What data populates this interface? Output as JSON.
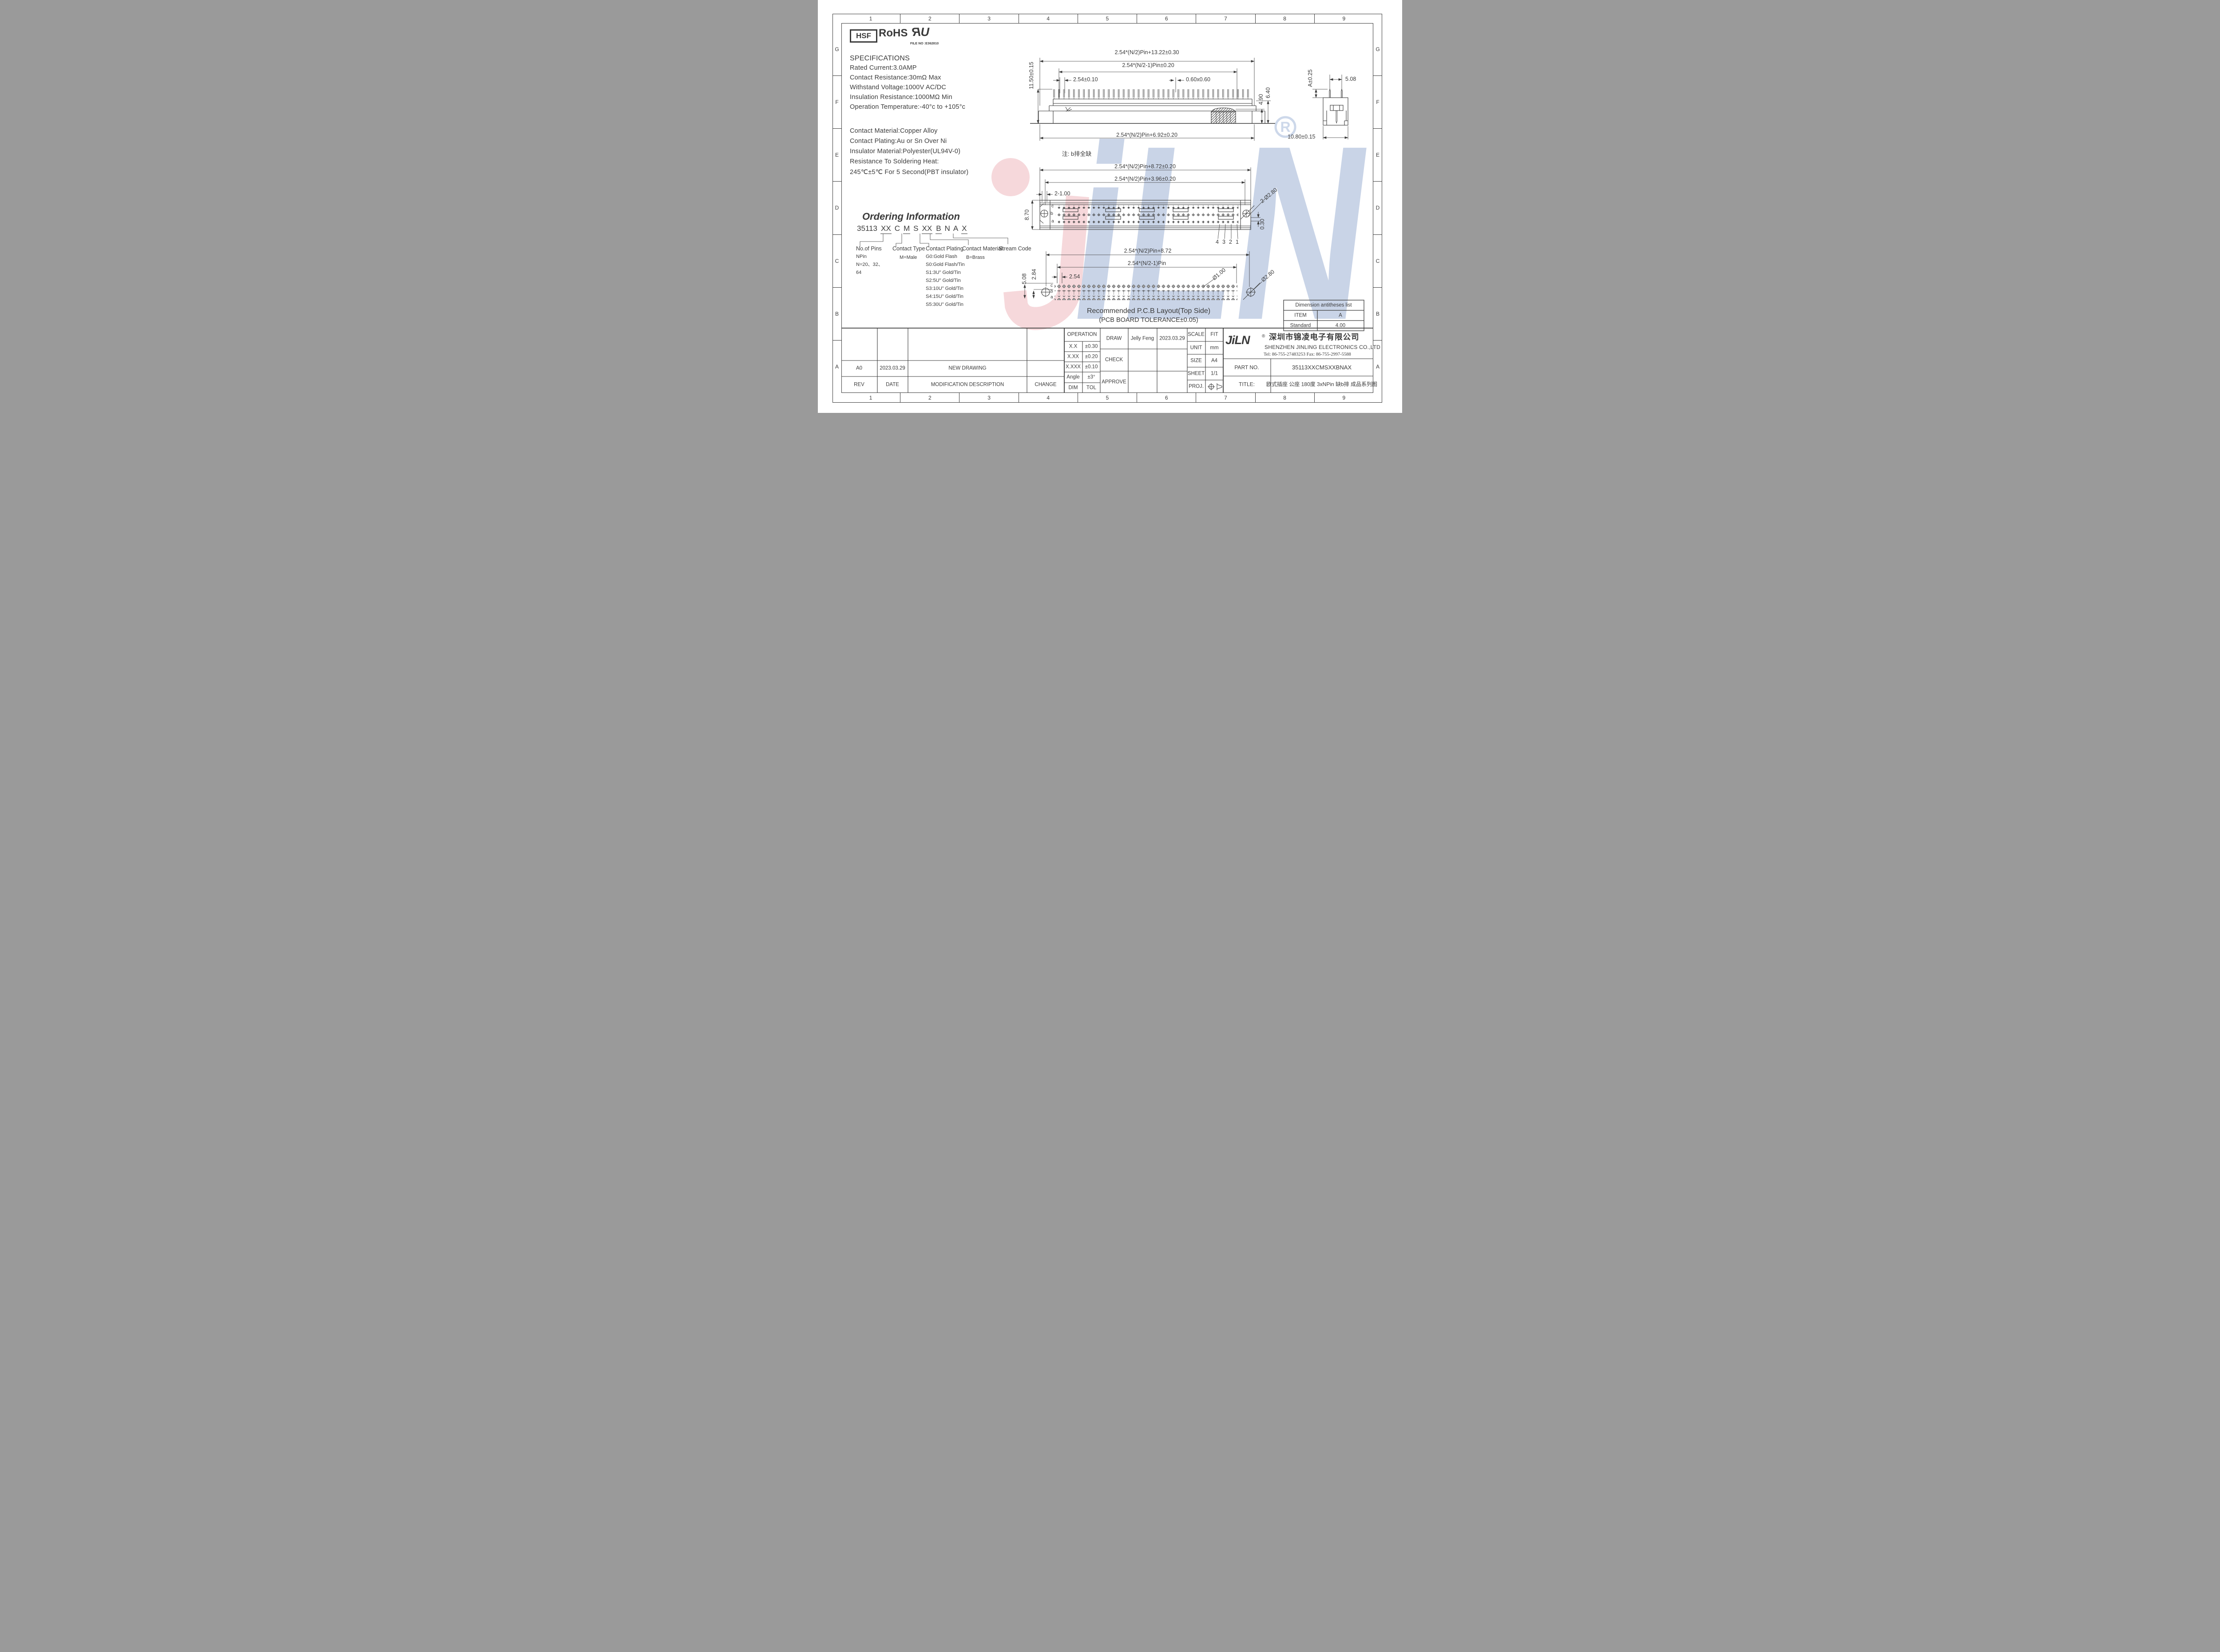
{
  "sheet": {
    "line_color": "#3a3a3a",
    "watermark_blue": "#c9d4e7",
    "watermark_pink": "#f5d6da"
  },
  "border": {
    "columns": [
      "1",
      "2",
      "3",
      "4",
      "5",
      "6",
      "7",
      "8",
      "9"
    ],
    "rows": [
      "G",
      "F",
      "E",
      "D",
      "C",
      "B",
      "A"
    ]
  },
  "certs": {
    "hsf": "HSF",
    "rohs": "RoHS",
    "ul_r": "R",
    "ul_u": "U",
    "ul_file": "FILE NO :E362810"
  },
  "specs": {
    "title": "SPECIFICATIONS",
    "lines": [
      "Rated Current:3.0AMP",
      "Contact Resistance:30mΩ Max",
      "Withstand Voltage:1000V AC/DC",
      "Insulation Resistance:1000MΩ Min",
      "Operation Temperature:-40°c to +105°c"
    ],
    "material_lines": [
      "Contact Material:Copper Alloy",
      "Contact Plating:Au or Sn Over Ni",
      "Insulator Material:Polyester(UL94V-0)",
      "Resistance To Soldering Heat:",
      "245℃±5℃ For 5 Second(PBT insulator)"
    ]
  },
  "ordering": {
    "title": "Ordering Information",
    "code": [
      {
        "t": "35113"
      },
      {
        "t": "XX"
      },
      {
        "t": "C"
      },
      {
        "t": "M"
      },
      {
        "t": "S"
      },
      {
        "t": "XX"
      },
      {
        "t": "B"
      },
      {
        "t": "N"
      },
      {
        "t": "A"
      },
      {
        "t": "X"
      }
    ],
    "no_of_pins": {
      "label": "No.of Pins",
      "l1": "NPin",
      "l2": "N=20、32、",
      "l3": "64"
    },
    "contact_type": {
      "label": "Contact Type",
      "l1": "M=Male"
    },
    "contact_plating": {
      "label": "Contact Plating",
      "lines": [
        "G0:Gold Flash",
        "S0:Gold Flash/Tin",
        "S1:3U\" Gold/Tin",
        "S2:5U\" Gold/Tin",
        "S3:10U\" Gold/Tin",
        "S4:15U\" Gold/Tin",
        "S5:30U\" Gold/Tin"
      ]
    },
    "contact_material": {
      "label": "Contact Material",
      "l1": "B=Brass"
    },
    "stream_code": {
      "label": "Stream Code"
    }
  },
  "views": {
    "top": {
      "d_overall": "2.54*(N/2)Pin+13.22±0.30",
      "d_inner": "2.54*(N/2-1)Pin±0.20",
      "d_pitch": "2.54±0.10",
      "d_pin": "0.60x0.60",
      "d_height": "11.50±0.15",
      "d_peg": "4.90",
      "d_step": "6.40",
      "d_bottom": "2.54*(N/2)Pin+6.92±0.20",
      "note": "注: b排全缺"
    },
    "side": {
      "d_a": "A±0.25",
      "d_span": "5.08",
      "d_width": "10.80±0.15"
    },
    "front": {
      "d1": "2.54*(N/2)Pin+8.72±0.20",
      "d2": "2.54*(N/2)Pin+3.96±0.20",
      "d_slot": "2-1.00",
      "d_height": "8.70",
      "d_holes": "2-Ø2.80",
      "d_offset": "0.30",
      "row_c": "c",
      "row_b": "b",
      "row_a": "a",
      "pin4": "4",
      "pin3": "3",
      "pin2": "2",
      "pin1": "1"
    },
    "pcb": {
      "d1": "2.54*(N/2)Pin+8.72",
      "d2": "2.54*(N/2-1)Pin",
      "d_pitch": "2.54",
      "d_row": "5.08",
      "d_row2": "2.84",
      "d_hole_small": "Ø1.00",
      "d_hole_big": "Ø2.80",
      "row_c": "c",
      "row_b": "b",
      "row_a": "a",
      "caption1": "Recommended P.C.B Layout(Top Side)",
      "caption2": "(PCB BOARD TOLERANCE±0.05)"
    }
  },
  "dim_table": {
    "title": "Dimension antitheses list",
    "rows": [
      [
        "ITEM",
        "A"
      ],
      [
        "Standard",
        "4.00"
      ]
    ]
  },
  "title_block": {
    "operation": {
      "header": "OPERATION",
      "rows": [
        [
          "X.X",
          "±0.30"
        ],
        [
          "X.XX",
          "±0.20"
        ],
        [
          "X.XXX",
          "±0.10"
        ],
        [
          "Angle",
          "±3°"
        ],
        [
          "DIM",
          "TOL"
        ]
      ]
    },
    "sign": {
      "draw": "DRAW",
      "draw_name": "Jelly Feng",
      "draw_date": "2023.03.29",
      "check": "CHECK",
      "approve": "APPROVE"
    },
    "info": {
      "scale_label": "SCALE",
      "scale": "FIT",
      "unit_label": "UNIT",
      "unit": "mm",
      "size_label": "SIZE",
      "size": "A4",
      "sheet_label": "SHEET",
      "sheet": "1/1",
      "proj_label": "PROJ."
    },
    "company": {
      "logo": "JiLN",
      "reg": "®",
      "cn": "深圳市锦凌电子有限公司",
      "en": "SHENZHEN JINLING ELECTRONICS CO.,LTD",
      "tel": "Tel: 86-755-27483253  Fax: 86-755-2997-5588",
      "part_label": "PART NO.",
      "part_no": "35113XXCMSXXBNAX",
      "title_label": "TITLE:",
      "title": "欧式插座 公座 180度 3xNPin 缺b排 成品系列图"
    }
  },
  "revision": {
    "rev": "A0",
    "date": "2023.03.29",
    "desc": "NEW DRAWING",
    "change": "",
    "h_rev": "REV",
    "h_date": "DATE",
    "h_desc": "MODIFICATION DESCRIPTION",
    "h_change": "CHANGE"
  }
}
